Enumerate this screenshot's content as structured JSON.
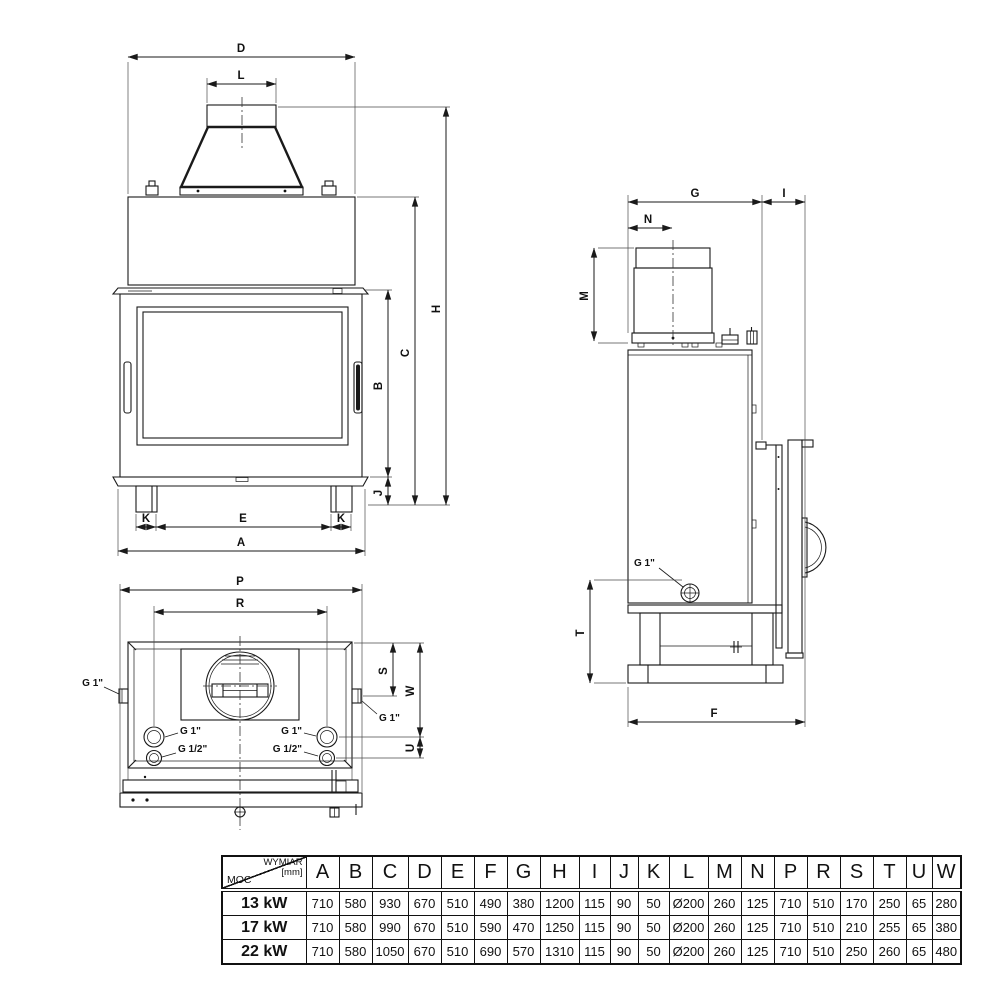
{
  "dim_labels": {
    "A": "A",
    "B": "B",
    "C": "C",
    "D": "D",
    "E": "E",
    "F": "F",
    "G": "G",
    "H": "H",
    "I": "I",
    "J": "J",
    "K": "K",
    "L": "L",
    "M": "M",
    "N": "N",
    "P": "P",
    "R": "R",
    "S": "S",
    "T": "T",
    "U": "U",
    "W": "W"
  },
  "port_labels": {
    "g1": "G 1\"",
    "g12": "G 1/2\""
  },
  "table": {
    "corner": {
      "top": "WYMIAR",
      "unit": "[mm]",
      "bottom": "MOC"
    },
    "columns": [
      "A",
      "B",
      "C",
      "D",
      "E",
      "F",
      "G",
      "H",
      "I",
      "J",
      "K",
      "L",
      "M",
      "N",
      "P",
      "R",
      "S",
      "T",
      "U",
      "W"
    ],
    "rows": [
      {
        "label": "13 kW",
        "values": [
          "710",
          "580",
          "930",
          "670",
          "510",
          "490",
          "380",
          "1200",
          "115",
          "90",
          "50",
          "Ø200",
          "260",
          "125",
          "710",
          "510",
          "170",
          "250",
          "65",
          "280"
        ]
      },
      {
        "label": "17 kW",
        "values": [
          "710",
          "580",
          "990",
          "670",
          "510",
          "590",
          "470",
          "1250",
          "115",
          "90",
          "50",
          "Ø200",
          "260",
          "125",
          "710",
          "510",
          "210",
          "255",
          "65",
          "380"
        ]
      },
      {
        "label": "22 kW",
        "values": [
          "710",
          "580",
          "1050",
          "670",
          "510",
          "690",
          "570",
          "1310",
          "115",
          "90",
          "50",
          "Ø200",
          "260",
          "125",
          "710",
          "510",
          "250",
          "260",
          "65",
          "480"
        ]
      }
    ]
  }
}
